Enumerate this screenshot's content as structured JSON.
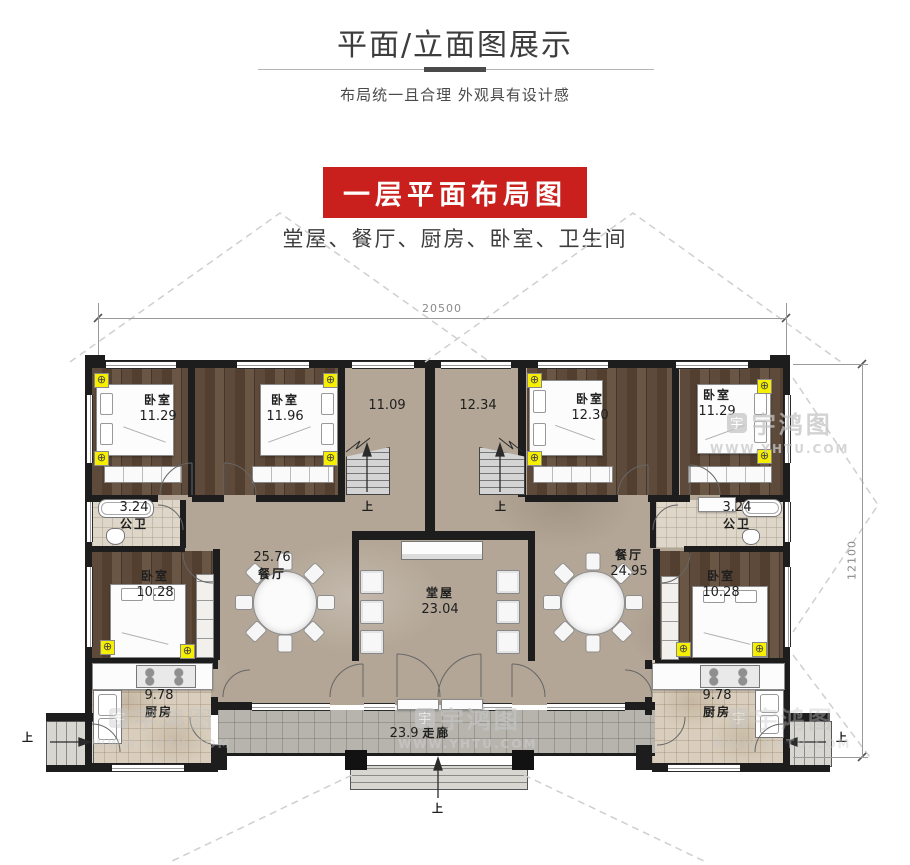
{
  "page": {
    "title": "平面/立面图展示",
    "subtitle": "布局统一且合理  外观具有设计感",
    "banner": "一层平面布局图",
    "rooms_summary": "堂屋、餐厅、厨房、卧室、卫生间"
  },
  "colors": {
    "banner_red": "#c9201d",
    "wall_black": "#1d1d1d",
    "marker_yellow": "#f6ef00",
    "dim_gray": "#8a8a8a"
  },
  "plan": {
    "dim_width": "20500",
    "dim_height": "12100",
    "up": "上",
    "rooms": {
      "bedroom_a": {
        "name": "卧室",
        "area": "11.29"
      },
      "bedroom_b": {
        "name": "卧室",
        "area": "11.96"
      },
      "stair_left": {
        "area": "11.09"
      },
      "stair_right": {
        "area": "12.34"
      },
      "bedroom_c": {
        "name": "卧室",
        "area": "12.30"
      },
      "bedroom_d": {
        "name": "卧室",
        "area": "11.29"
      },
      "bath_left": {
        "name": "公卫",
        "area": "3.24"
      },
      "bath_right": {
        "name": "公卫",
        "area": "3.24"
      },
      "bedroom_l2": {
        "name": "卧室",
        "area": "10.28"
      },
      "bedroom_r2": {
        "name": "卧室",
        "area": "10.28"
      },
      "dining_left": {
        "name": "餐厅",
        "area": "25.76"
      },
      "dining_right": {
        "name": "餐厅",
        "area": "24.95"
      },
      "main_hall": {
        "name": "堂屋",
        "area": "23.04"
      },
      "kitchen_left": {
        "name": "厨房",
        "area": "9.78"
      },
      "kitchen_right": {
        "name": "厨房",
        "area": "9.78"
      },
      "corridor": {
        "name": "走廊",
        "area": "23.9"
      }
    },
    "watermark": {
      "logo": "宇",
      "name": "宇鸿图",
      "url": "WWW.YHTU.COM"
    }
  }
}
